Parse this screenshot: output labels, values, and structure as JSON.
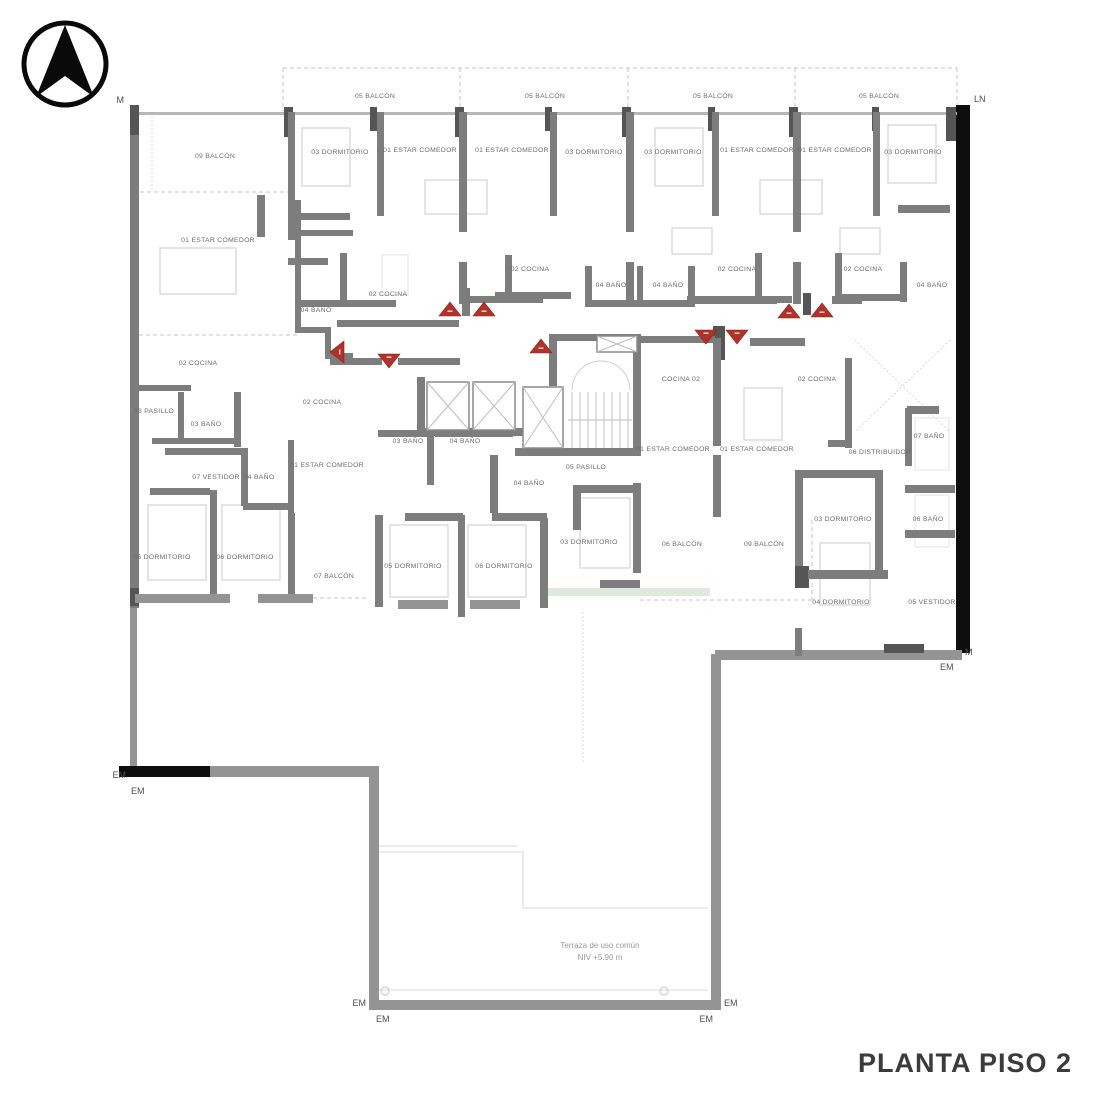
{
  "title": "PLANTA PISO 2",
  "terrace": {
    "line1": "Terraza de uso común",
    "line2": "NIV +5.90 m"
  },
  "boundary": {
    "m_top_left": "M",
    "ln_top_right": "LN",
    "m_right": "M",
    "em_right": "EM",
    "em_left_1": "EM",
    "em_left_2": "EM",
    "em_bottom_left_1": "EM",
    "em_bottom_left_2": "EM",
    "em_bottom_right_1": "EM",
    "em_bottom_right_2": "EM"
  },
  "colors": {
    "wall_gray": "#7d7d7d",
    "party_wall_black": "#0e0e0e",
    "terrace_wall_gray": "#949494",
    "entry_marker_red": "#b03228",
    "terrace_accent_green": "#dfe9df",
    "title_text": "#3b3b3b"
  },
  "rooms": [
    {
      "label": "05 BALCÓN"
    },
    {
      "label": "05 BALCÓN"
    },
    {
      "label": "05 BALCÓN"
    },
    {
      "label": "05 BALCÓN"
    },
    {
      "label": "09 BALCÓN"
    },
    {
      "label": "03 DORMITORIO"
    },
    {
      "label": "01 ESTAR COMEDOR"
    },
    {
      "label": "01 ESTAR COMEDOR"
    },
    {
      "label": "03 DORMITORIO"
    },
    {
      "label": "03 DORMITORIO"
    },
    {
      "label": "01 ESTAR COMEDOR"
    },
    {
      "label": "01 ESTAR COMEDOR"
    },
    {
      "label": "03 DORMITORIO"
    },
    {
      "label": "01 ESTAR COMEDOR"
    },
    {
      "label": "02 COCINA"
    },
    {
      "label": "02 COCINA"
    },
    {
      "label": "02 COCINA"
    },
    {
      "label": "04 BAÑO"
    },
    {
      "label": "04 BAÑO"
    },
    {
      "label": "04 BAÑO"
    },
    {
      "label": "02 COCINA"
    },
    {
      "label": "04 BAÑO"
    },
    {
      "label": "02 COCINA"
    },
    {
      "label": "08 PASILLO"
    },
    {
      "label": "03 BAÑO"
    },
    {
      "label": "02 COCINA"
    },
    {
      "label": "03 BAÑO"
    },
    {
      "label": "04 BAÑO"
    },
    {
      "label": "04 BAÑO"
    },
    {
      "label": "05 PASILLO"
    },
    {
      "label": "01 ESTAR COMEDOR"
    },
    {
      "label": "07 VESTIDOR"
    },
    {
      "label": "04 BAÑO"
    },
    {
      "label": "05 DORMITORIO"
    },
    {
      "label": "06 DORMITORIO"
    },
    {
      "label": "07 BALCÓN"
    },
    {
      "label": "05 DORMITORIO"
    },
    {
      "label": "06 DORMITORIO"
    },
    {
      "label": "03 DORMITORIO"
    },
    {
      "label": "06 BALCÓN"
    },
    {
      "label": "09 BALCÓN"
    },
    {
      "label": "COCINA 02"
    },
    {
      "label": "02 COCINA"
    },
    {
      "label": "01 ESTAR COMEDOR"
    },
    {
      "label": "01 ESTAR COMEDOR"
    },
    {
      "label": "06 DISTRIBUIDOR"
    },
    {
      "label": "07 BAÑO"
    },
    {
      "label": "06 BAÑO"
    },
    {
      "label": "03 DORMITORIO"
    },
    {
      "label": "04 DORMITORIO"
    },
    {
      "label": "05 VESTIDOR"
    }
  ]
}
